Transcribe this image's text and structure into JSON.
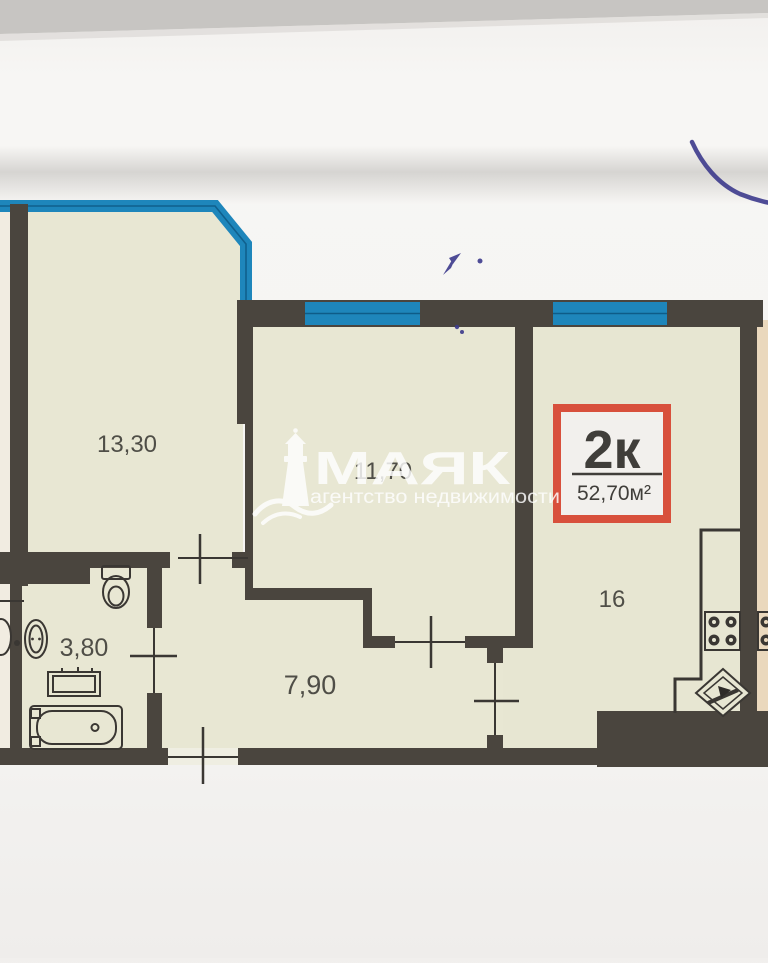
{
  "watermark": {
    "brand": "МАЯК",
    "tagline": "агентство недвижимости",
    "icon": "lighthouse-icon"
  },
  "badge": {
    "rooms_label": "2к",
    "area_label": "52,70м²"
  },
  "room_labels": [
    {
      "name": "living-room",
      "label": "13,30"
    },
    {
      "name": "bedroom",
      "label": "11,70"
    },
    {
      "name": "kitchen-living",
      "label": "16"
    },
    {
      "name": "bathroom",
      "label": "3,80"
    },
    {
      "name": "hallway",
      "label": "7,90"
    }
  ],
  "icons": [
    "lighthouse-icon",
    "toilet-icon",
    "sink-icon",
    "washing-machine-icon",
    "bathtub-icon",
    "stove-icon",
    "kitchen-sink-icon",
    "door-swing-tick"
  ],
  "colors": {
    "paper": "#f5f4f2",
    "top_band_gray": "#c7c5c2",
    "wall_dark": "#4a453e",
    "room_fill": "#e8e7d3",
    "window_blue": "#1e86bb",
    "window_blue_dark": "#0e5c88",
    "adjacent_unit_tan": "#ead8bd",
    "badge_red": "#d8503c",
    "badge_fill": "#f2f0ed",
    "label_gray": "#4f4e47",
    "pen_ink_blue": "#3c3a8c"
  }
}
